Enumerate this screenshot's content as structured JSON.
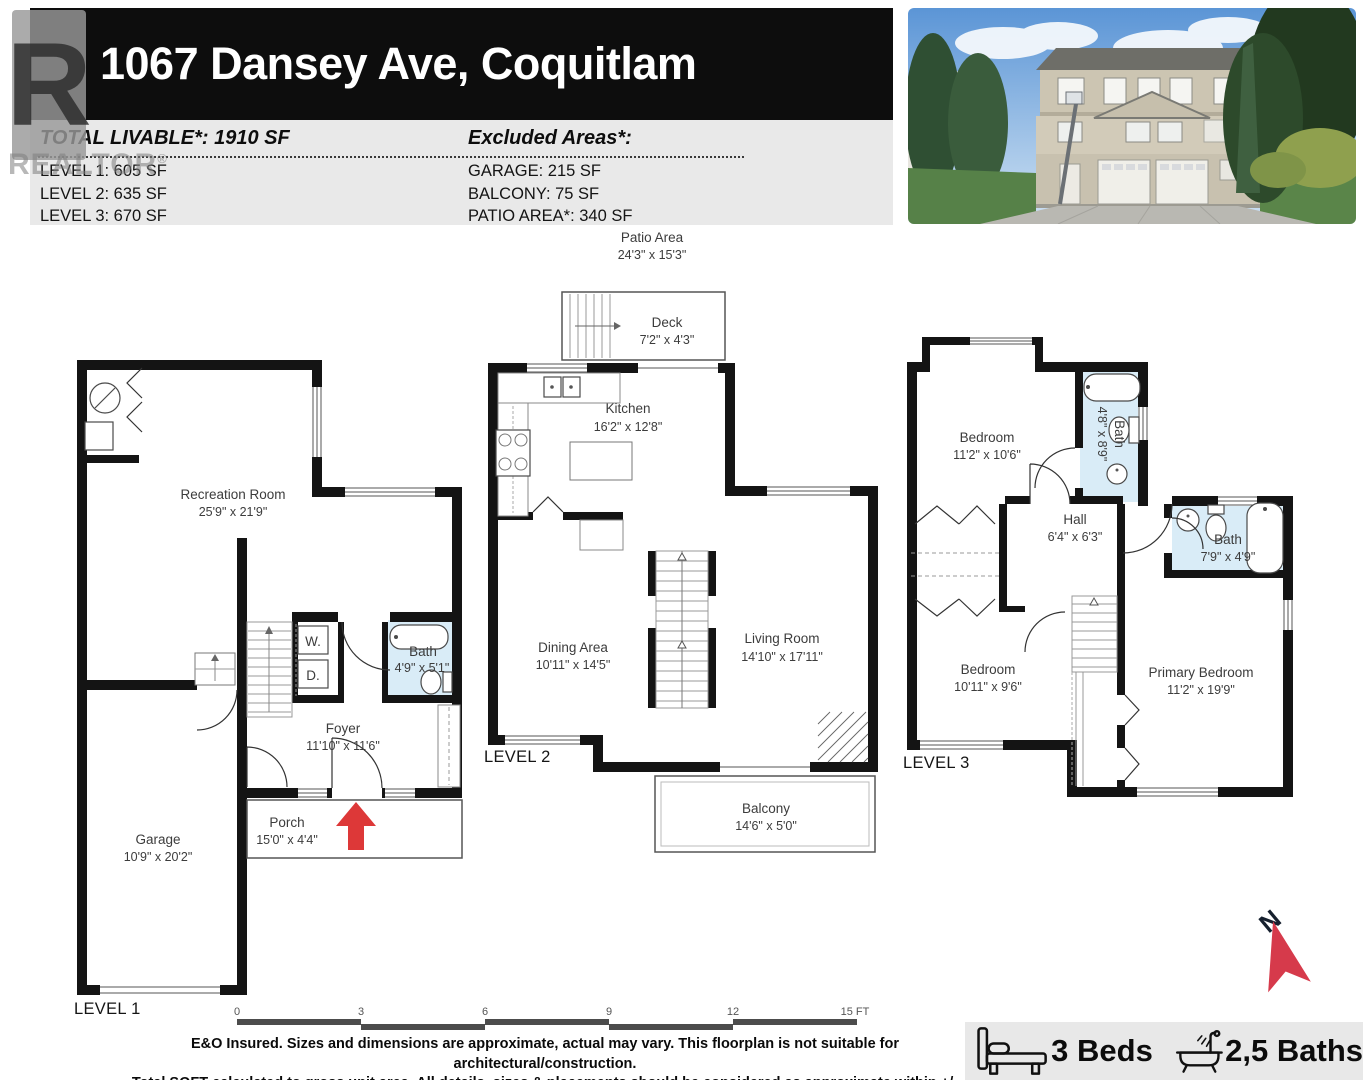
{
  "header": {
    "title": "1067 Dansey Ave, Coquitlam",
    "total_livable": "TOTAL LIVABLE*: 1910 SF",
    "levels": [
      "LEVEL 1: 605 SF",
      "LEVEL 2: 635 SF",
      "LEVEL 3: 670 SF"
    ],
    "excluded_title": "Excluded Areas*:",
    "excluded": [
      "GARAGE: 215 SF",
      "BALCONY: 75 SF",
      "PATIO AREA*: 340 SF"
    ]
  },
  "watermark": {
    "letter": "R",
    "text": "REALTOR",
    "reg": "®"
  },
  "floor1": {
    "label": "LEVEL 1",
    "recreation": {
      "name": "Recreation Room",
      "dims": "25'9\" x 21'9\""
    },
    "bath": {
      "name": "Bath",
      "dims": "4'9\" x 5'1\""
    },
    "washer": "W.",
    "dryer": "D.",
    "foyer": {
      "name": "Foyer",
      "dims": "11'10\" x 11'6\""
    },
    "garage": {
      "name": "Garage",
      "dims": "10'9\" x 20'2\""
    },
    "porch": {
      "name": "Porch",
      "dims": "15'0\" x 4'4\""
    }
  },
  "floor2": {
    "label": "LEVEL 2",
    "patio": {
      "name": "Patio Area",
      "dims": "24'3\" x 15'3\""
    },
    "deck": {
      "name": "Deck",
      "dims": "7'2\" x 4'3\""
    },
    "kitchen": {
      "name": "Kitchen",
      "dims": "16'2\" x 12'8\""
    },
    "dining": {
      "name": "Dining Area",
      "dims": "10'11\" x 14'5\""
    },
    "living": {
      "name": "Living Room",
      "dims": "14'10\" x 17'11\""
    },
    "balcony": {
      "name": "Balcony",
      "dims": "14'6\" x 5'0\""
    }
  },
  "floor3": {
    "label": "LEVEL 3",
    "bedroom1": {
      "name": "Bedroom",
      "dims": "11'2\" x 10'6\""
    },
    "bath1": {
      "name": "Bath",
      "dims": "4'8\" x 8'9\""
    },
    "hall": {
      "name": "Hall",
      "dims": "6'4\" x 6'3\""
    },
    "bath2": {
      "name": "Bath",
      "dims": "7'9\" x 4'9\""
    },
    "bedroom2": {
      "name": "Bedroom",
      "dims": "10'11\" x 9'6\""
    },
    "primary": {
      "name": "Primary Bedroom",
      "dims": "11'2\" x 19'9\""
    }
  },
  "scalebar": {
    "ticks": [
      "0",
      "3",
      "6",
      "9",
      "12",
      "15 FT"
    ]
  },
  "disclaimer": {
    "line1": "E&O Insured. Sizes and dimensions are approximate, actual may vary. This floorplan is not suitable for architectural/construction.",
    "line2": "Total SQFT calculated to gross unit area. All details, sizes & placements should be considered as approximate within +/- 3% tolerance."
  },
  "summary": {
    "beds": "3 Beds",
    "baths": "2,5 Baths"
  },
  "compass": {
    "label": "N"
  },
  "colors": {
    "bath_fill": "#d9ecf7",
    "arrow_red": "#dd3838",
    "wall": "#141414",
    "header_bg": "#0d0d0d",
    "strip_bg": "#e9e9e9"
  }
}
